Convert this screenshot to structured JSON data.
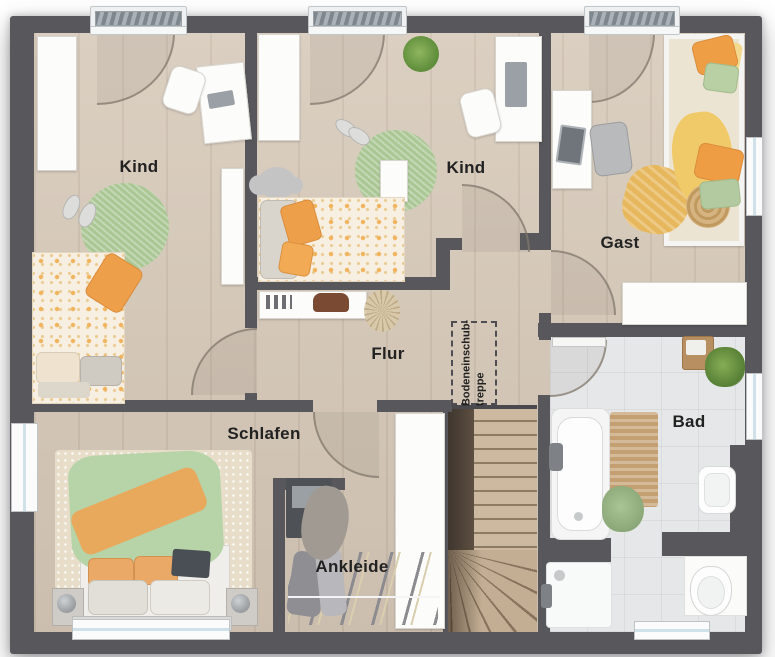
{
  "plan": {
    "rooms": {
      "kind_left": "Kind",
      "kind_middle": "Kind",
      "gast": "Gast",
      "flur": "Flur",
      "schlafen": "Schlafen",
      "ankleide": "Ankleide",
      "bad": "Bad",
      "attic_hatch": "Bodeneinschub-\ntreppe"
    },
    "colors": {
      "wall": "#58585c",
      "wood_floor": "#d4c6b5",
      "tile_floor": "#e6e7e8",
      "stair_wood": "#c6b097",
      "accent_orange": "#ee9f49",
      "accent_green": "#b3cda0",
      "accent_yellow": "#eec768",
      "rug_green": "#abc795"
    }
  }
}
